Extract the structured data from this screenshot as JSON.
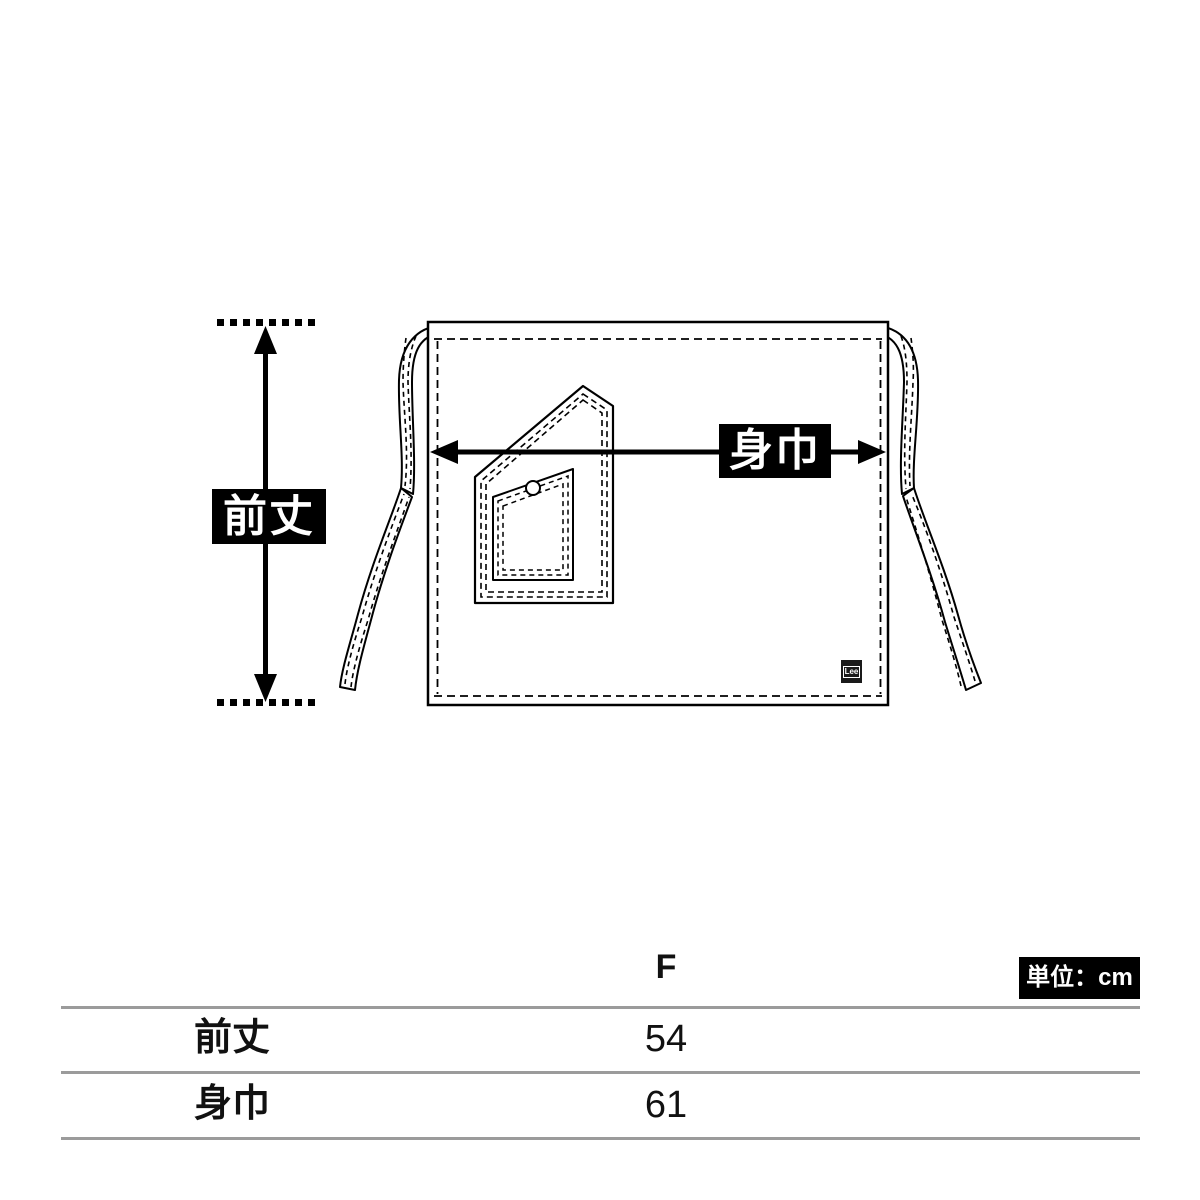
{
  "diagram": {
    "front_length_label": "前丈",
    "body_width_label": "身巾",
    "brand_patch": "Lee"
  },
  "table": {
    "unit_label": "単位：cm",
    "size_column": "F",
    "rows": [
      {
        "label": "前丈",
        "value": "54"
      },
      {
        "label": "身巾",
        "value": "61"
      }
    ]
  },
  "colors": {
    "line_black": "#000000",
    "label_bg": "#000000",
    "label_text": "#ffffff",
    "table_rule_gray": "#9b9b9b",
    "background": "#ffffff"
  }
}
